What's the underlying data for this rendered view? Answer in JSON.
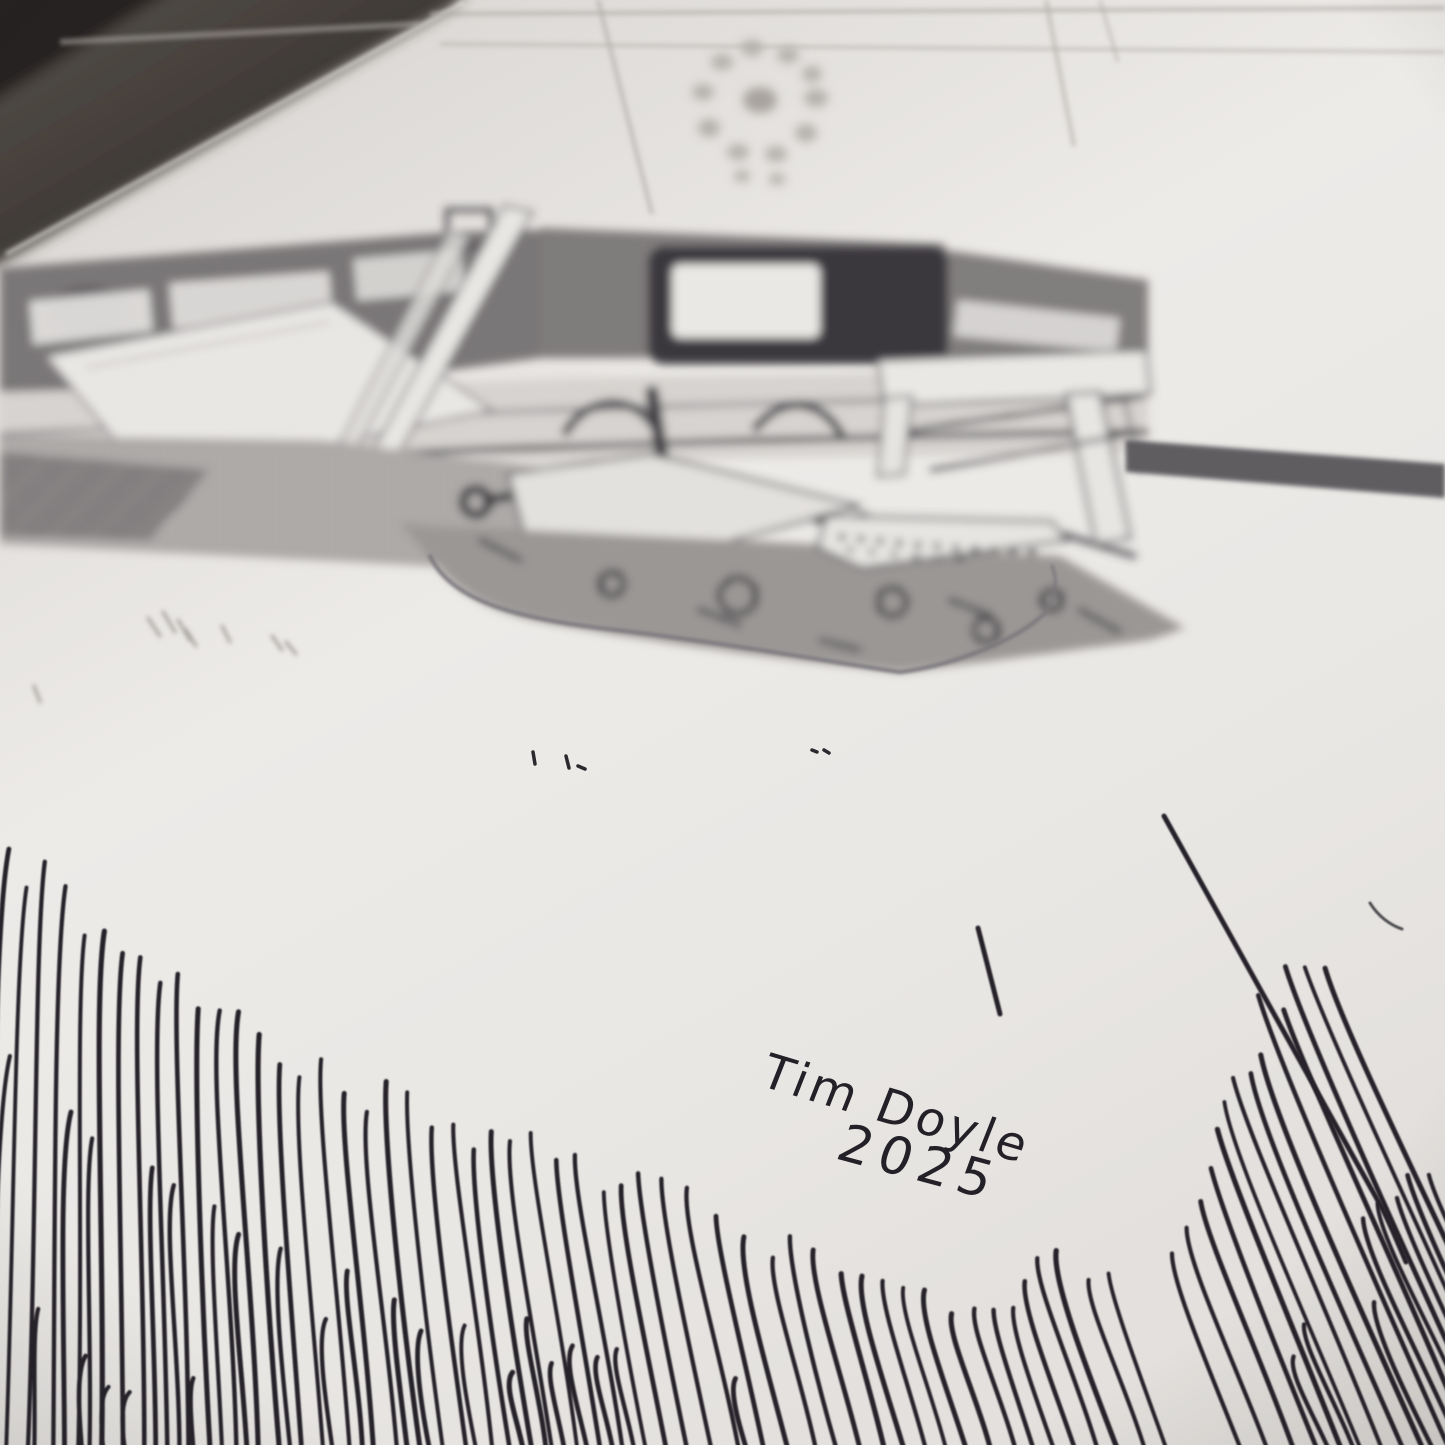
{
  "photo": {
    "description": "Angled photograph of a hand-drawn black ink illustration on white paper: an out-of-focus desk scene (monitor, office chair, keyboard, side table) with a sharp fan of hand-hatched rays in the foreground, signed by the artist",
    "background_color": "#37332f",
    "paper_color": "#eae8e5",
    "ink_color": "#26242a"
  },
  "artwork": {
    "signature_name": "Tim Doyle",
    "signature_year": "2025",
    "hatch_fan": {
      "vanishing_point": {
        "x": 120,
        "y": -1700
      },
      "bottom_y": 1478,
      "spacing": 23,
      "second_row_offset": 215,
      "second_row_probability": 0.55,
      "main": {
        "x_start": -40,
        "x_end": 1185,
        "top_profile": [
          [
            -40,
            845
          ],
          [
            30,
            885
          ],
          [
            90,
            925
          ],
          [
            150,
            962
          ],
          [
            210,
            998
          ],
          [
            270,
            1030
          ],
          [
            330,
            1060
          ],
          [
            390,
            1087
          ],
          [
            450,
            1112
          ],
          [
            510,
            1134
          ],
          [
            570,
            1152
          ],
          [
            630,
            1167
          ],
          [
            690,
            1182
          ],
          [
            750,
            1206
          ],
          [
            810,
            1236
          ],
          [
            870,
            1264
          ],
          [
            930,
            1290
          ],
          [
            990,
            1312
          ],
          [
            1050,
            1302
          ],
          [
            1110,
            1272
          ],
          [
            1185,
            1252
          ]
        ]
      },
      "right": {
        "x_start": 1252,
        "x_end": 1560,
        "top_profile": [
          [
            1252,
            1245
          ],
          [
            1300,
            1205
          ],
          [
            1350,
            1145
          ],
          [
            1400,
            1085
          ],
          [
            1450,
            1025
          ],
          [
            1500,
            985
          ],
          [
            1560,
            950
          ]
        ]
      }
    }
  }
}
